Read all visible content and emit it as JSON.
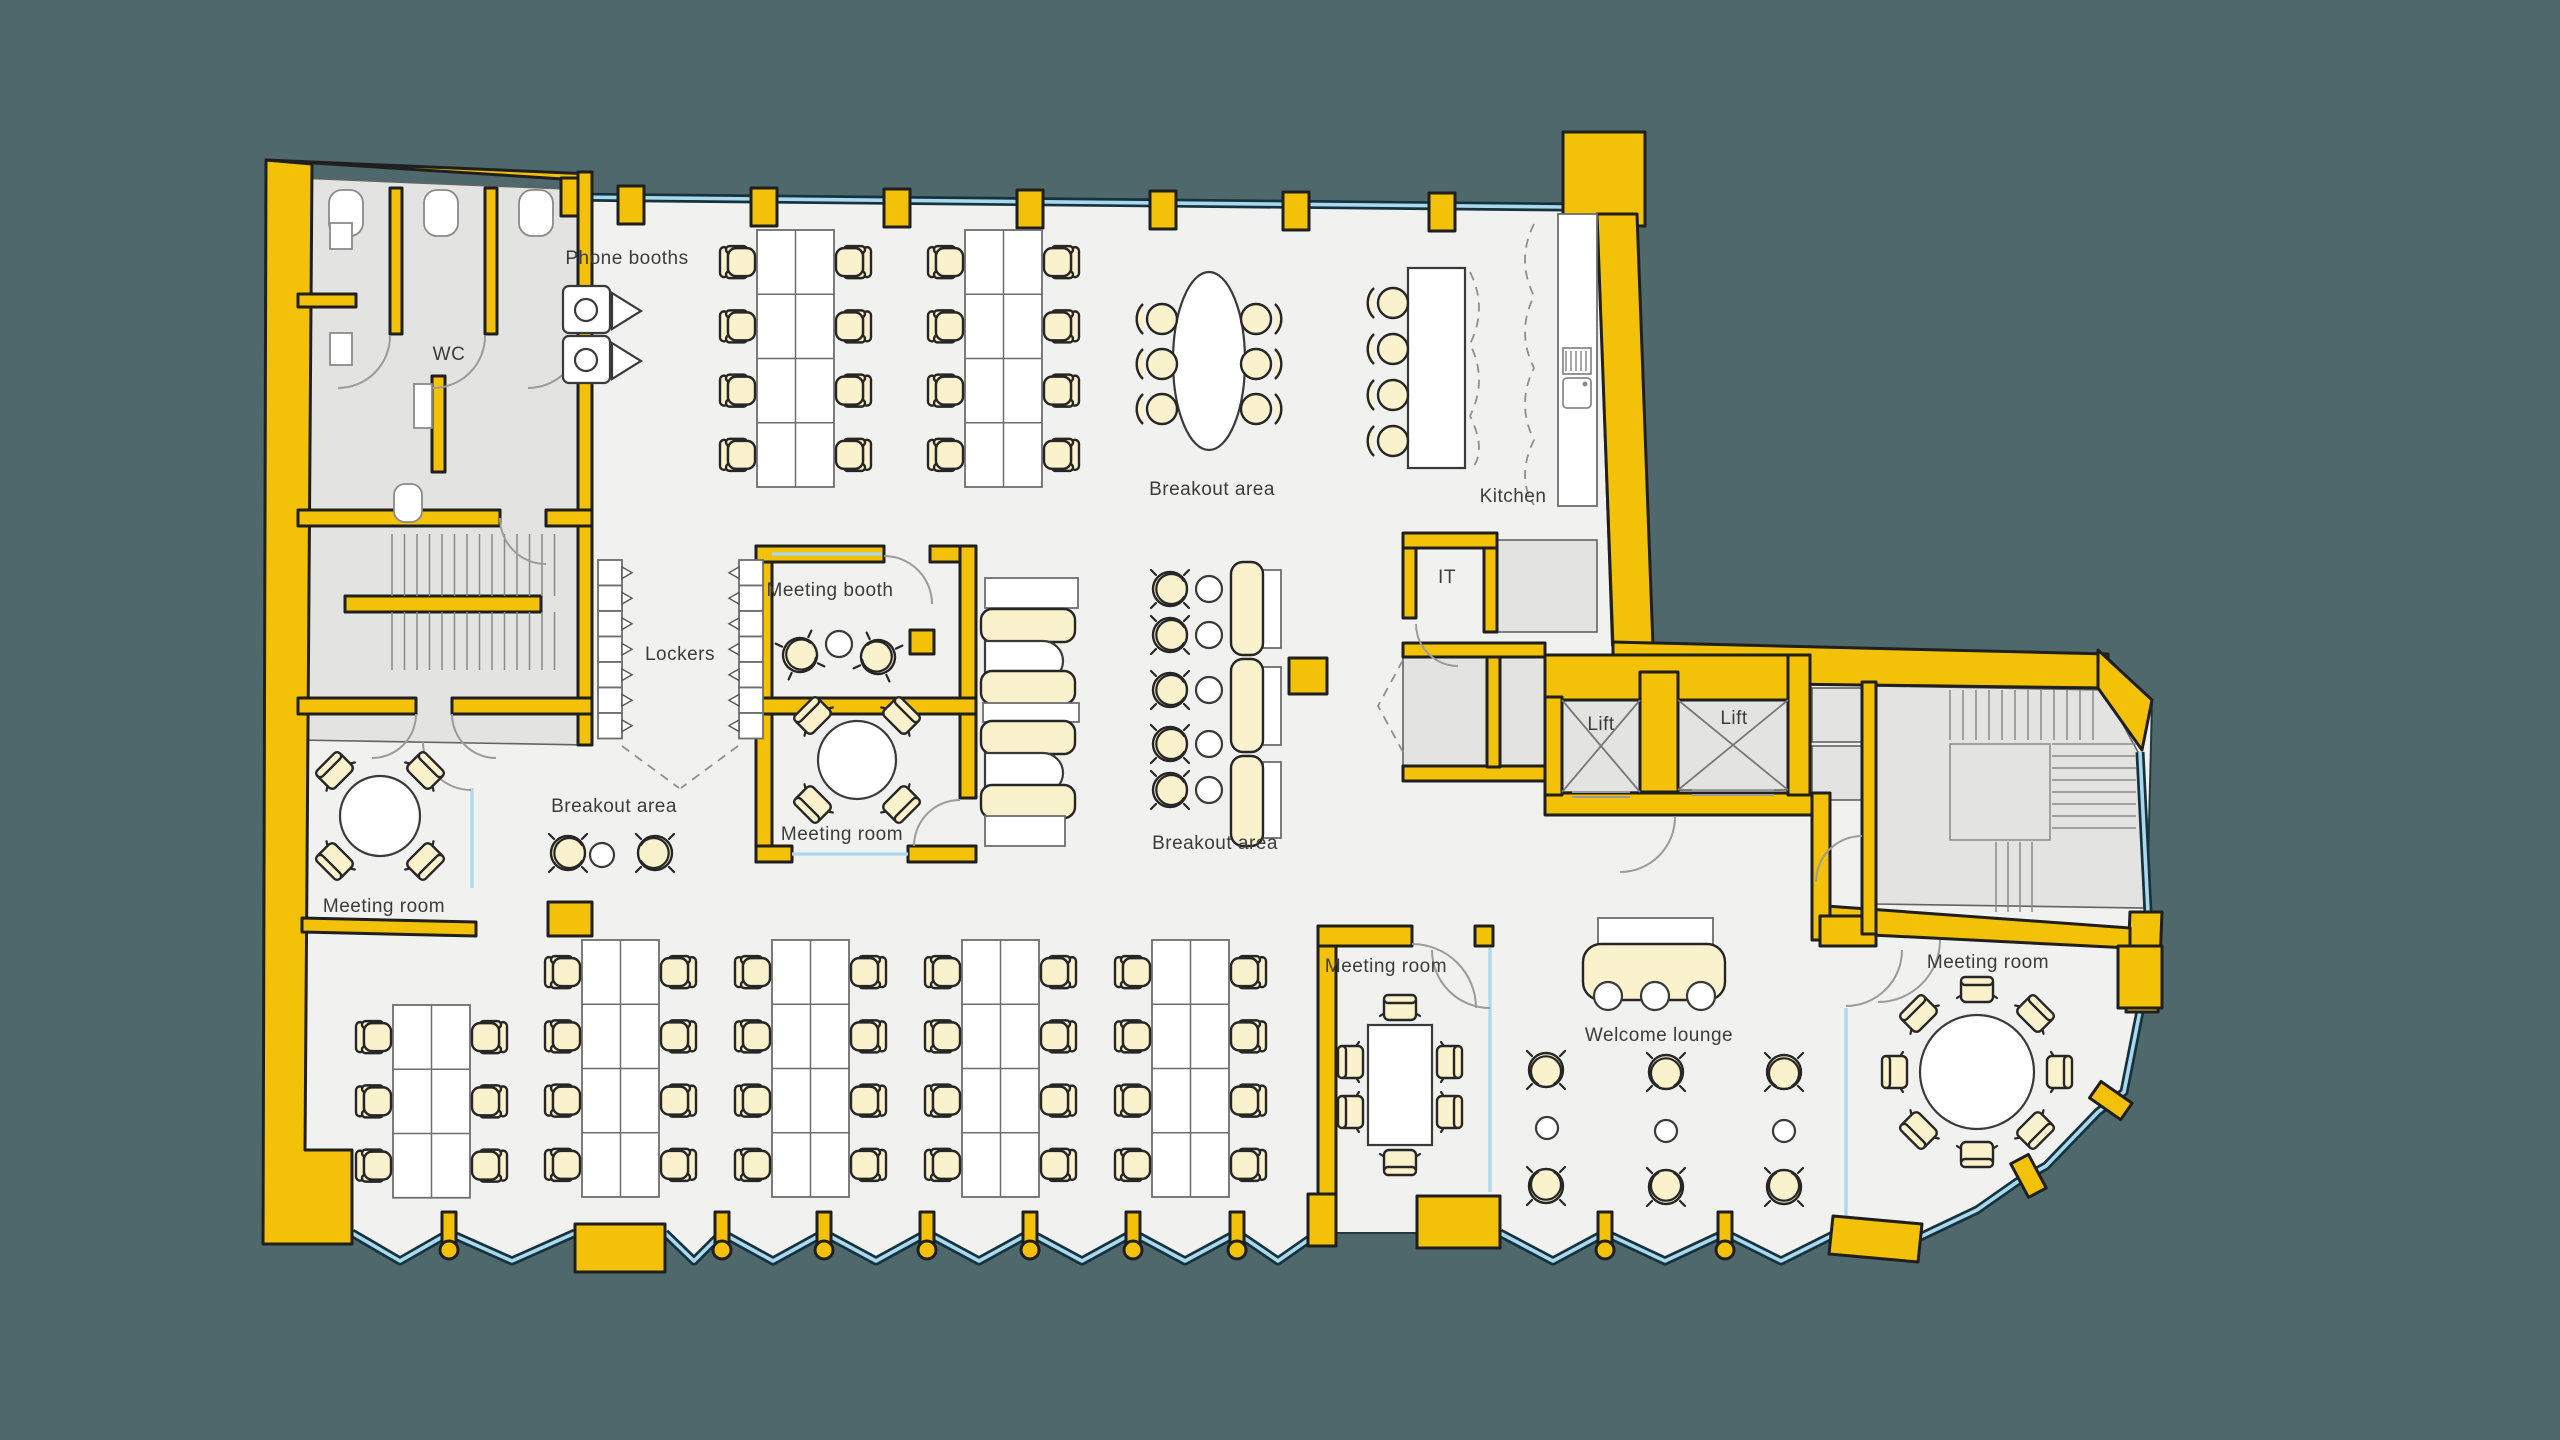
{
  "colors": {
    "background": "#4e686b",
    "wall": "#f3c208",
    "outline": "#1f1f1f",
    "floor": "#f1f1f0",
    "zone": "#e3e3e1",
    "furniture": "#faf1cd",
    "desk": "#ffffff",
    "glazing": "#a9d9ee",
    "glazing_frame": "#15323d",
    "label": "#3c3c3c"
  },
  "labels": {
    "phone_booths": "Phone booths",
    "wc": "WC",
    "breakout_top": "Breakout area",
    "kitchen": "Kitchen",
    "it": "IT",
    "meeting_booth": "Meeting booth",
    "lockers": "Lockers",
    "meeting_room_center": "Meeting room",
    "breakout_middle": "Breakout area",
    "breakout_left": "Breakout area",
    "meeting_room_left": "Meeting room",
    "lift_left": "Lift",
    "lift_right": "Lift",
    "meeting_room_bottom": "Meeting room",
    "welcome_lounge": "Welcome lounge",
    "meeting_room_right": "Meeting room"
  }
}
